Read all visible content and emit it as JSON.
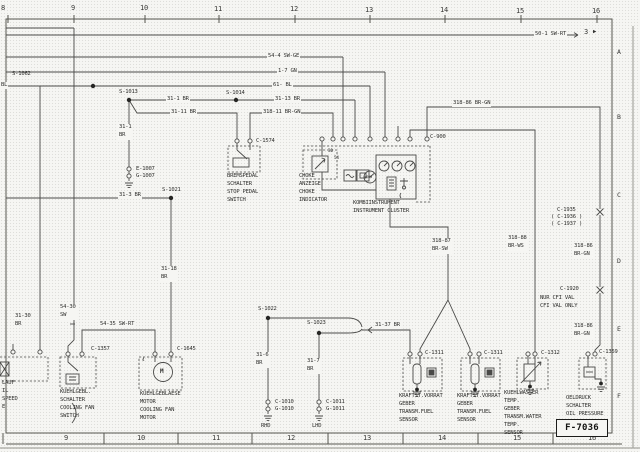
{
  "frame": {
    "ruler_top": [
      "8",
      "9",
      "10",
      "11",
      "12",
      "13",
      "14",
      "15",
      "16"
    ],
    "ruler_bottom": [
      "9",
      "10",
      "11",
      "12",
      "13",
      "14",
      "15",
      "16"
    ],
    "margin_letters": [
      "A",
      "B",
      "C",
      "D",
      "E",
      "F"
    ],
    "sheet_code": "F-7036",
    "sheet_ref": {
      "number": "3",
      "arrow": "▶"
    }
  },
  "wires": {
    "w50_1": "50-1 SW-RT",
    "w54_4": "54-4 SW-GE",
    "w1_7": "1-7 GN",
    "w61": "61- BL",
    "bl_fragment": "BL",
    "w31_1h": "31-1 BR",
    "w31_13": "31-13 BR",
    "w31_11": "31-11 BR",
    "w318_11": "318-11 BR-GN",
    "w318_86_top": "318-86 BR-GN",
    "w318_86_mid": "318-86\nBR-GN",
    "w318_86_low": "318-86\nBR-GN",
    "w318_87": "318-87\nBR-SW",
    "w318_88": "318-88\nBR-WS",
    "w31_1v": "31-1\nBR",
    "w31_3": "31-3 BR",
    "w31_18": "31-18\nBR",
    "w54_30": "54-30\nSW",
    "w54_35": "54-35 SW-RT",
    "w31_30": "31-30\nBR",
    "w31_6": "31-6\nBR",
    "w31_7": "31-7\nBR",
    "w31_37": "31-37 BR"
  },
  "splices": {
    "s1062": "S-1062",
    "s1013": "S-1013",
    "s1014": "S-1014",
    "s1021": "S-1021",
    "s1022": "S-1022",
    "s1023": "S-1023"
  },
  "connectors": {
    "c1574": "C-1574",
    "c900": "C-900",
    "e1007": "E-1007",
    "g1007": "G-1007",
    "c1357": "C-1357",
    "c1645": "C-1645",
    "c1010": "C-1010",
    "g1010": "G-1010",
    "c1011": "C-1011",
    "g1011": "G-1011",
    "c1311a": "C-1311",
    "c1311b": "C-1311",
    "c1312": "C-1312",
    "c1359": "C-1359",
    "c1935": "C-1935",
    "c1936": "( C-1936 )",
    "c1937": "( C-1937 )",
    "c1920": "C-1920"
  },
  "pins": {
    "p30": "30",
    "p54": "54",
    "p4": "4"
  },
  "symbols": {
    "motor": "M",
    "tach": "x600"
  },
  "components": {
    "brake_switch": "BREMSPEDAL\nSCHALTER\nSTOP PEDAL\nSWITCH",
    "choke_indicator": "CHOKE\nANZEIGE\nCHOKE\nINDICATOR",
    "instrument_cluster": "KOMBIINSTRUMENT\nINSTRUMENT CLUSTER",
    "fan_switch": "KUEHLGEBL.\nSCHALTER\nCOOLING FAN\nSWITCH",
    "fan_motor": "KUEHLGEBLAESE\nMOTOR\nCOOLING FAN\nMOTOR",
    "fuel_sensor_1": "KRAFTST.VORRAT\nGEBER\nTRANSM.FUEL\nSENSOR",
    "fuel_sensor_2": "KRAFTST.VORRAT\nGEBER\nTRANSM.FUEL\nSENSOR",
    "water_temp_sensor": "KUEHLWASSER\nTEMP.\nGEBER\nTRANSM.WATER\nTEMP.\nSENSOR",
    "oil_pressure_switch": "OELDRUCK\nSCHALTER\nOIL PRESSURE\nSWITCH",
    "idle_fragment": "LAUF\nIL\nSPEED\nE"
  },
  "notes": {
    "cfi": "NUR CFI VAL\nCFI VAL ONLY",
    "rhd": "RHD",
    "lhd": "LHD"
  }
}
